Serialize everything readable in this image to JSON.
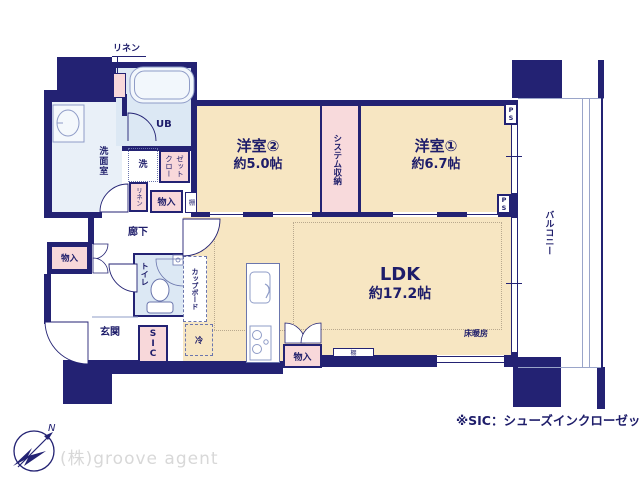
{
  "rooms": {
    "bedroom2": {
      "name": "洋室②",
      "size": "約5.0帖"
    },
    "bedroom1": {
      "name": "洋室①",
      "size": "約6.7帖"
    },
    "ldk": {
      "name": "LDK",
      "size": "約17.2帖"
    },
    "system_storage": "システム収納",
    "washroom": "洗面室",
    "unit_bath": "UB",
    "hallway": "廊下",
    "toilet": "トイレ",
    "entrance": "玄関",
    "shoe_closet": "SIC",
    "balcony": "バルコニー",
    "cupboard": "カップボード",
    "refrigerator": "冷",
    "floor_heating": "床暖房"
  },
  "storage": {
    "linen_top": "リネン",
    "linen_hall": "リネン",
    "closet_lines": [
      "クロー",
      "ゼット"
    ],
    "storage_hall": "物入",
    "shelf_hall": "棚",
    "storage_left": "物入",
    "storage_ldk": "物入",
    "shelf_ldk": "棚",
    "washer": "洗",
    "pipe_space": "PS"
  },
  "annotations": {
    "footnote": "※SIC：シューズインクローゼット",
    "watermark": "(株)groove agent",
    "compass_north": "N"
  },
  "colors": {
    "wall": "#232273",
    "floor": "#f7e6c2",
    "storage_pink": "#f8d8da",
    "wet_blue": "#dce8f4",
    "text": "#1e1d6a"
  }
}
